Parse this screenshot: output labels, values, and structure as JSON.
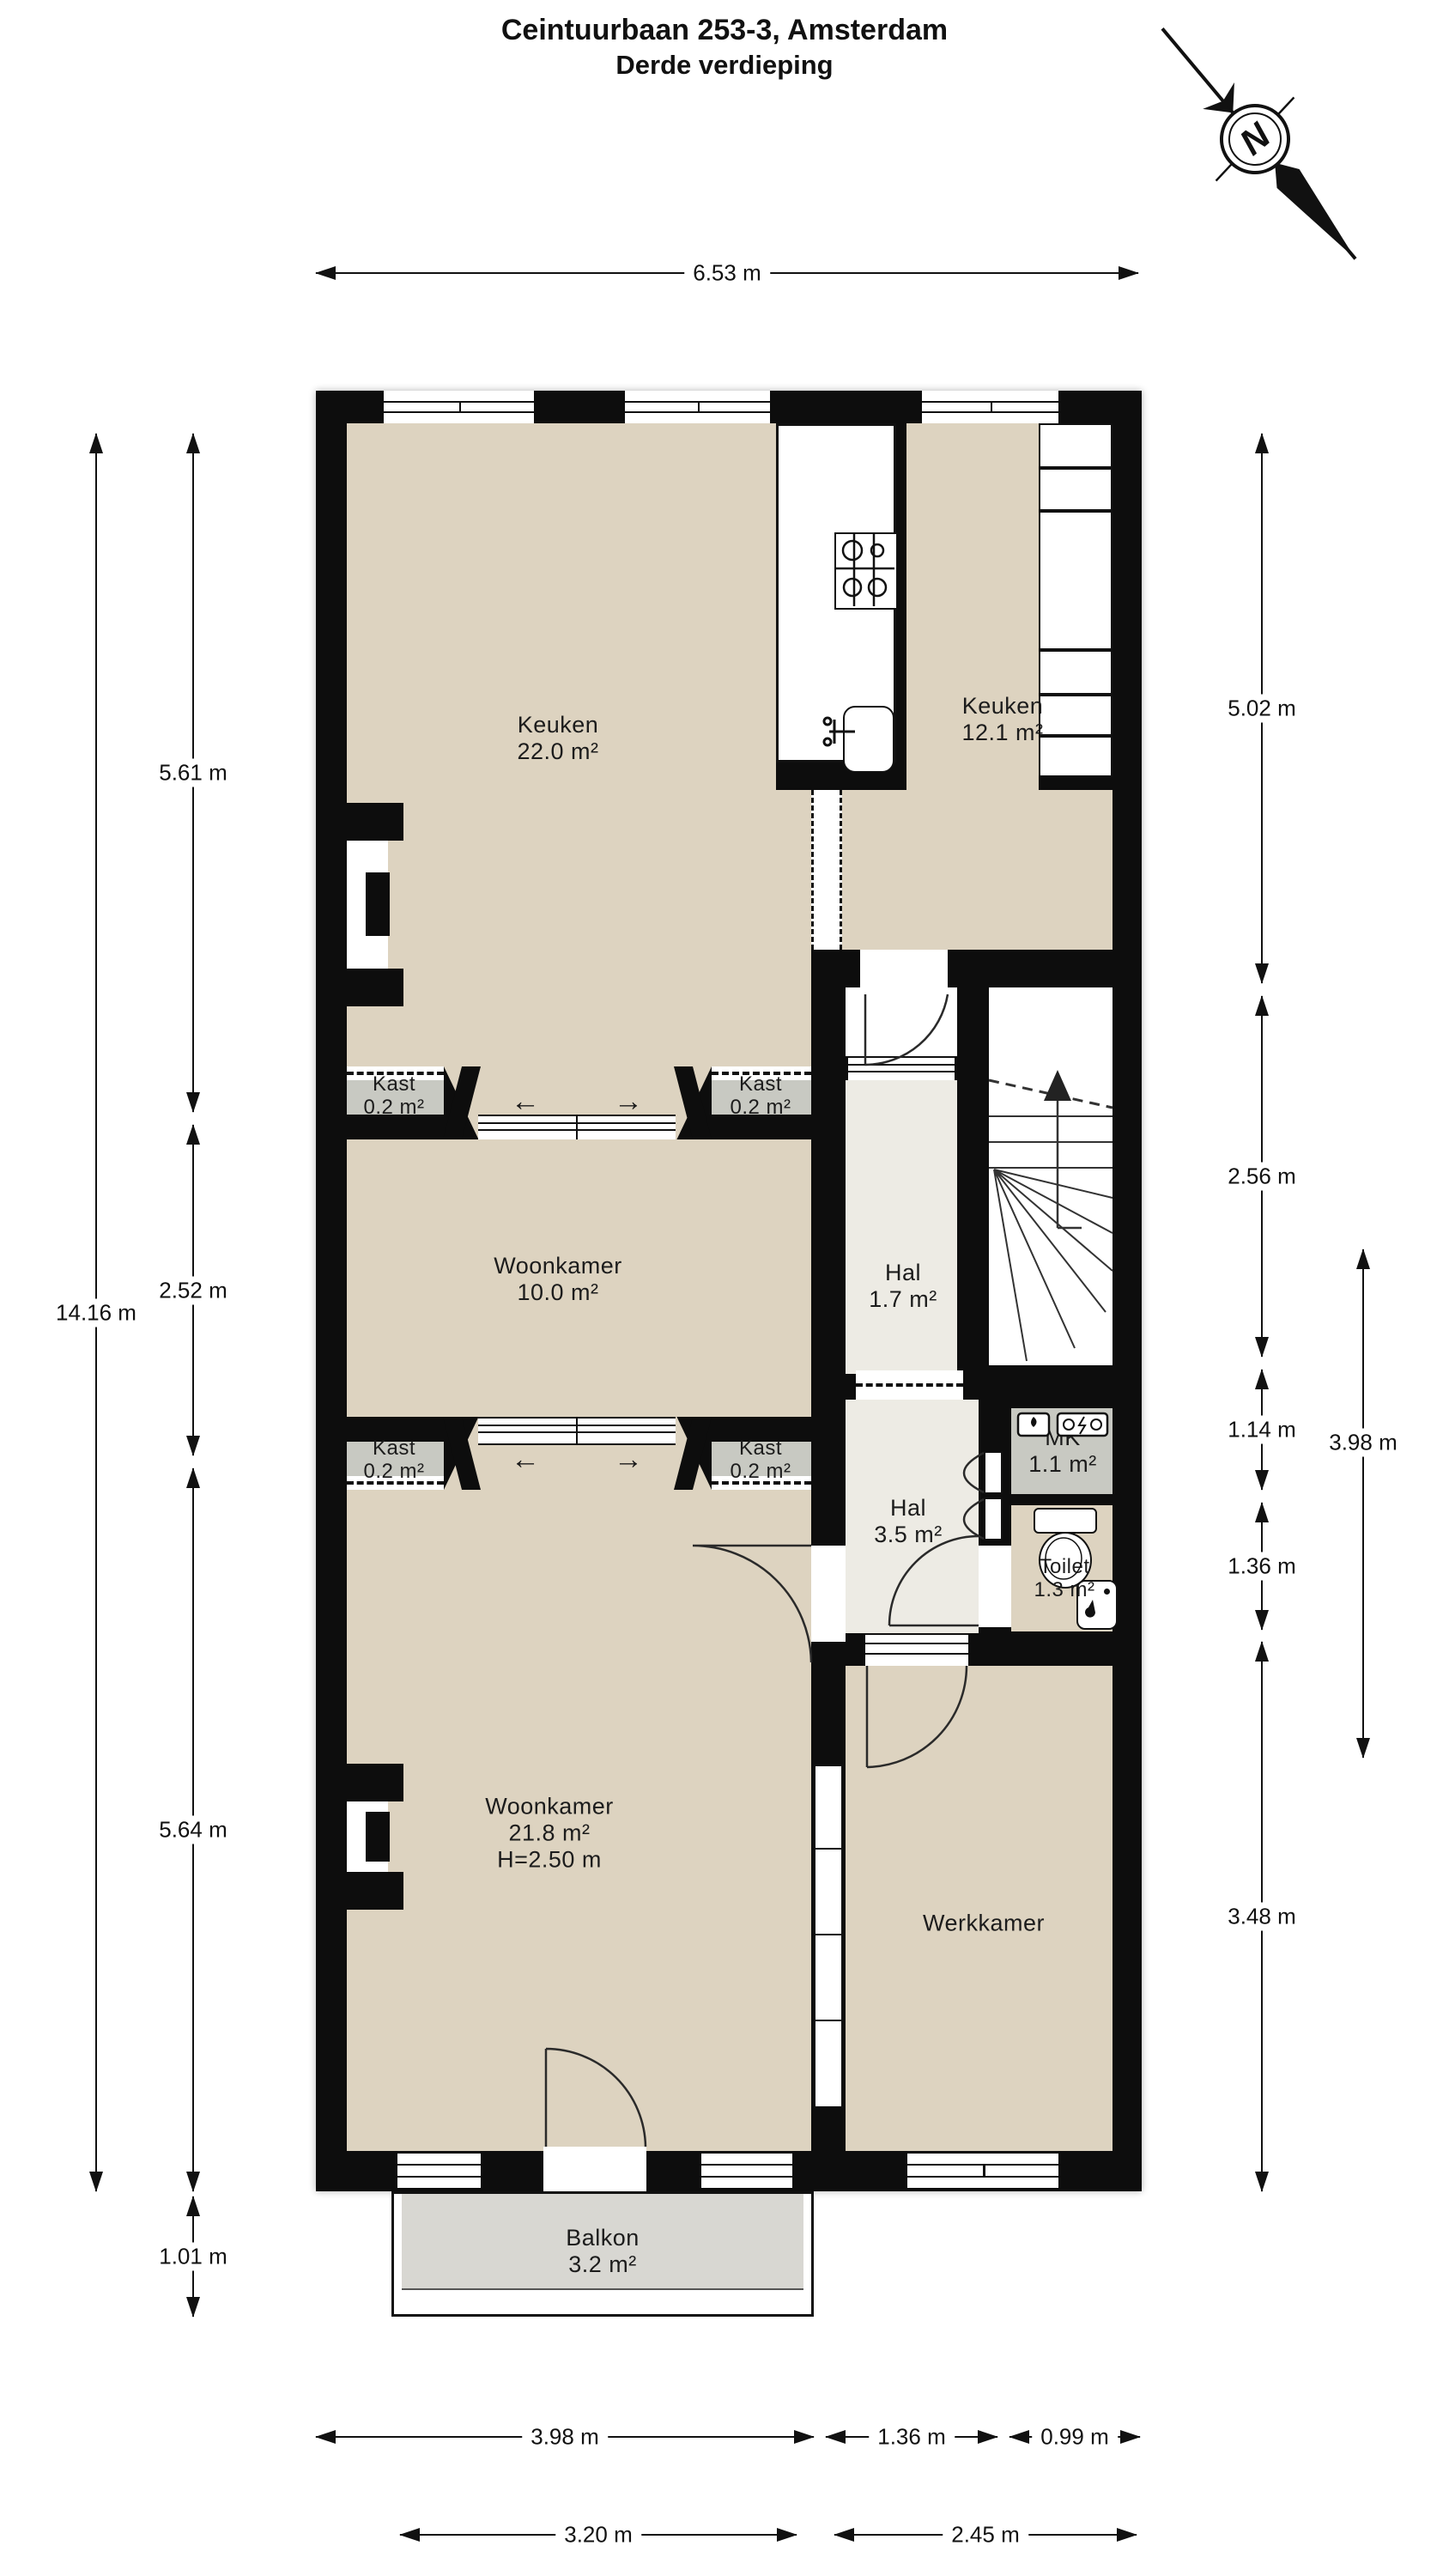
{
  "title": {
    "line1": "Ceintuurbaan 253-3, Amsterdam",
    "line2": "Derde verdieping"
  },
  "compass": {
    "label": "N"
  },
  "rooms": {
    "keuken_22": {
      "name": "Keuken",
      "area": "22.0 m²"
    },
    "keuken_12": {
      "name": "Keuken",
      "area": "12.1 m²"
    },
    "kast_nw": {
      "name": "Kast",
      "area": "0.2 m²"
    },
    "kast_ne": {
      "name": "Kast",
      "area": "0.2 m²"
    },
    "kast_sw": {
      "name": "Kast",
      "area": "0.2 m²"
    },
    "kast_se": {
      "name": "Kast",
      "area": "0.2 m²"
    },
    "woonkamer_10": {
      "name": "Woonkamer",
      "area": "10.0 m²"
    },
    "hal_17": {
      "name": "Hal",
      "area": "1.7 m²"
    },
    "mk": {
      "name": "MK",
      "area": "1.1 m²"
    },
    "hal_35": {
      "name": "Hal",
      "area": "3.5 m²"
    },
    "toilet": {
      "name": "Toilet",
      "area": "1.3 m²"
    },
    "woonkamer_218": {
      "name": "Woonkamer",
      "area": "21.8 m²",
      "height": "H=2.50 m"
    },
    "werkkamer": {
      "name": "Werkkamer"
    },
    "balkon": {
      "name": "Balkon",
      "area": "3.2 m²"
    }
  },
  "dimensions": {
    "top_width": "6.53 m",
    "left_total": "14.16 m",
    "left_segments": [
      "5.61 m",
      "2.52 m",
      "5.64 m",
      "1.01 m"
    ],
    "right_segments": [
      "5.02 m",
      "2.56 m",
      "1.14 m",
      "1.36 m",
      "3.48 m"
    ],
    "right_outer": "3.98 m",
    "bottom_row1": [
      "3.98 m",
      "1.36 m",
      "0.99 m"
    ],
    "bottom_row2": [
      "3.20 m",
      "2.45 m"
    ]
  },
  "icons": {
    "slide_left": "←",
    "slide_right": "→"
  },
  "colors": {
    "wall": "#0d0d0d",
    "room": "#ddd3c0",
    "hall": "#edebe4",
    "closet": "#c8c9c2",
    "balcony": "#d8d7d2"
  }
}
